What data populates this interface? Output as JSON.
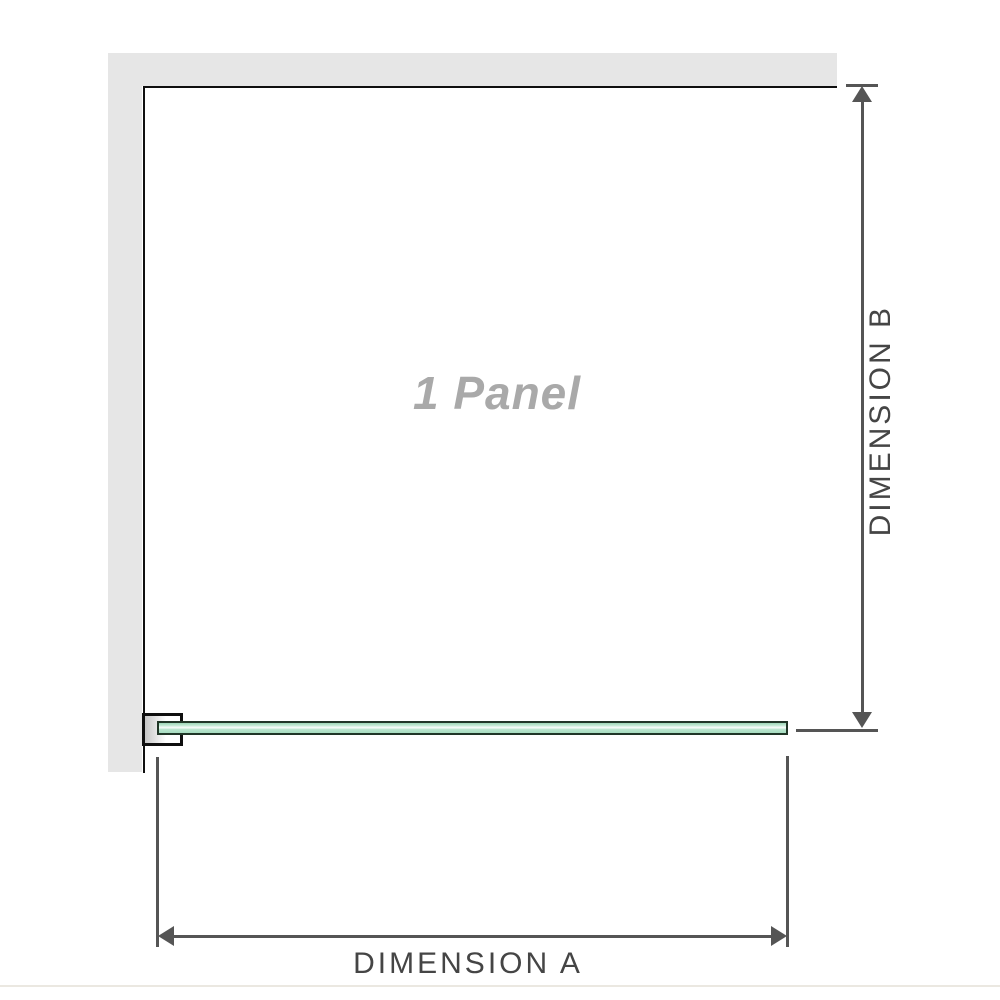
{
  "diagram": {
    "panel_label": "1 Panel",
    "dimensions": {
      "horizontal": {
        "label": "DIMENSION A"
      },
      "vertical": {
        "label": "DIMENSION B"
      }
    }
  },
  "colors": {
    "wall_gray": "#e6e6e6",
    "outline_black": "#0f0f0f",
    "glass_green": "#a6dcc0",
    "glass_border": "#203627",
    "dimension_gray": "#555555",
    "label_gray": "#a9a9a9",
    "text_dark": "#454545",
    "divider_color": "#ebe8e1"
  }
}
